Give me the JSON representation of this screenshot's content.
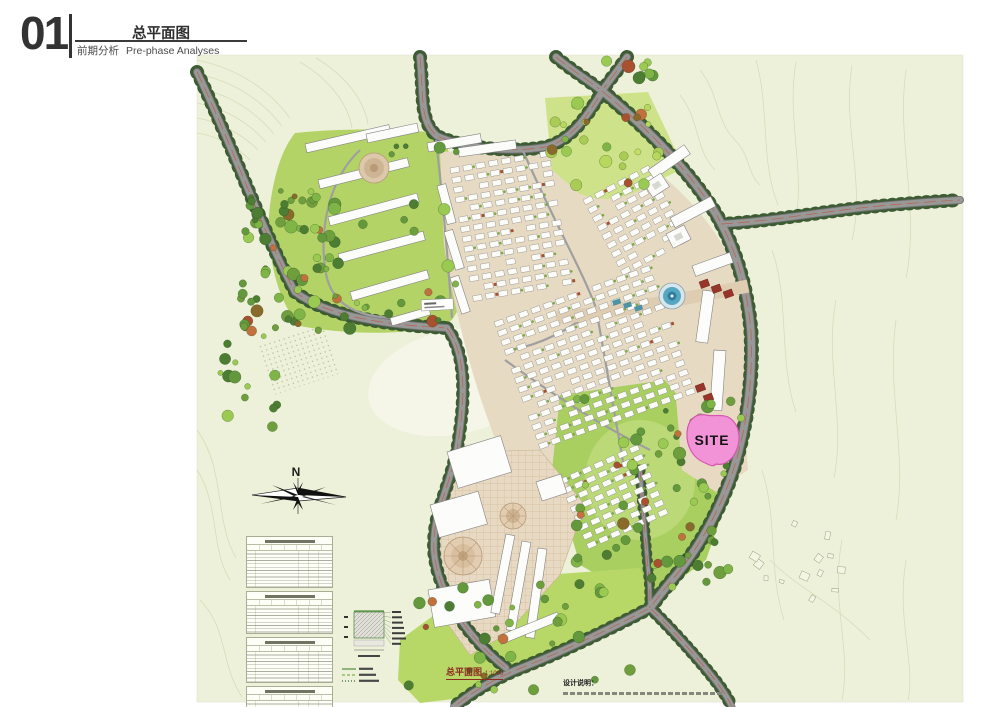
{
  "header": {
    "section_number": "01",
    "title": "总平面图",
    "subtitle_zh": "前期分析",
    "subtitle_en": "Pre-phase Analyses"
  },
  "map": {
    "site_label": "SITE",
    "compass_label": "N",
    "caption": {
      "title": "总平面图",
      "scale": "1:1000"
    },
    "notes_title": "设计说明：",
    "colors": {
      "site_pink": "#f293d8",
      "site_outline": "#d557ad",
      "caption_red": "#8d2a21",
      "road_gray": "#949494",
      "tree_green": "#3d5c34",
      "lawn_green": "#aed163",
      "paper": "#eef1d9"
    }
  }
}
